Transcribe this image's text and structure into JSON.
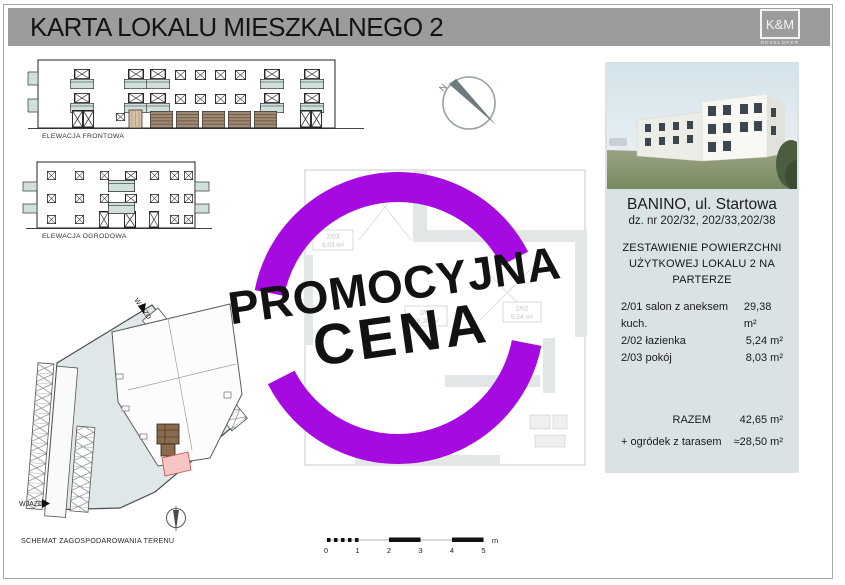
{
  "colors": {
    "stamp_purple": "#a50ae0",
    "panel_bg": "#d9e3e5",
    "header_gray": "#9c9c9c"
  },
  "header": {
    "title": "KARTA LOKALU MIESZKALNEGO 2",
    "logo_top": "K&M",
    "logo_bottom": "DEVELOPER"
  },
  "stamp": {
    "line1": "PROMOCYJNA",
    "line2": "CENA"
  },
  "elevations": {
    "front_label": "ELEWACJA FRONTOWA",
    "garden_label": "ELEWACJA OGRODOWA"
  },
  "site_plan": {
    "caption": "SCHEMAT ZAGOSPODAROWANIA TERENU",
    "entrance_top_label": "WJAZD",
    "entrance_left_label": "WJAZD"
  },
  "compass": {
    "north_mark": "N"
  },
  "floor_plan": {
    "rooms": [
      {
        "id": "2/03",
        "area": "8,03 m²"
      },
      {
        "id": "2/01",
        "area": "29,38 m²"
      },
      {
        "id": "2/02",
        "area": "5,24 m²"
      }
    ]
  },
  "scale_bar": {
    "ticks": [
      "0",
      "1",
      "2",
      "3",
      "4",
      "5"
    ],
    "unit": "m"
  },
  "info_panel": {
    "location": "BANINO, ul. Startowa",
    "plots": "dz. nr 202/32, 202/33,202/38",
    "table_title_line1": "ZESTAWIENIE POWIERZCHNI",
    "table_title_line2": "UŻYTKOWEJ LOKALU 2 NA PARTERZE",
    "rows": [
      {
        "label": "2/01 salon z aneksem kuch.",
        "value": "29,38 m²"
      },
      {
        "label": "2/02 łazienka",
        "value": "5,24 m²"
      },
      {
        "label": "2/03 pokój",
        "value": "8,03 m²"
      }
    ],
    "total_label": "RAZEM",
    "total_value": "42,65 m²",
    "garden_label": "+ ogródek z tarasem",
    "garden_value": "≈28,50 m²"
  }
}
